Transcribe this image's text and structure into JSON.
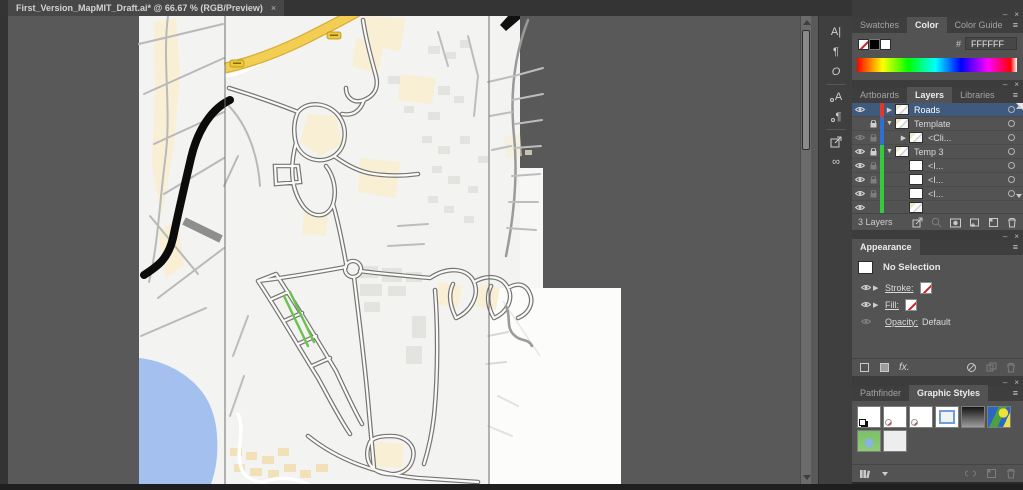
{
  "window": {
    "tab_title": "First_Version_MapMIT_Draft.ai* @ 66.67 % (RGB/Preview)",
    "tab_close_glyph": "×"
  },
  "colors": {
    "pasteboard": "#595959",
    "panel_body": "#535353",
    "panel_tabs_bg": "#3e3e3e",
    "selected_layer_row": "#3f5a7c",
    "layer_color_roads": "#e0392b",
    "layer_color_template": "#2f6fd0",
    "layer_color_temp3": "#35c93f",
    "map_background": "#f3f3f1",
    "map_water": "#a3c0ee",
    "map_major_road_yellow": "#f3ce55",
    "map_heavy_road_black": "#0b0b0b",
    "map_parcel_cream": "#f8efd5",
    "map_green_street": "#69c24a",
    "hex_swatch": "#FFFFFF"
  },
  "dock": {
    "items": [
      {
        "name": "character-panel-icon",
        "glyph": "A|"
      },
      {
        "name": "paragraph-panel-icon",
        "glyph": "¶"
      },
      {
        "name": "opentype-panel-icon",
        "glyph": "O"
      },
      {
        "name": "character-styles-panel-icon",
        "glyph": "A"
      },
      {
        "name": "paragraph-styles-panel-icon",
        "glyph": "¶"
      },
      {
        "name": "export-panel-icon",
        "glyph": ""
      },
      {
        "name": "links-panel-icon",
        "glyph": "∞"
      }
    ]
  },
  "panel_controls": {
    "minimize_glyph": "–",
    "close_glyph": "×",
    "menu_glyph": "≡"
  },
  "panels": {
    "color": {
      "tabs": {
        "swatches": "Swatches",
        "color": "Color",
        "color_guide": "Color Guide"
      },
      "active_tab": "Color",
      "hash_label": "#",
      "hex_value": "FFFFFF"
    },
    "layers": {
      "tabs": {
        "artboards": "Artboards",
        "layers": "Layers",
        "libraries": "Libraries"
      },
      "active_tab": "Layers",
      "rows": [
        {
          "name": "Roads",
          "color": "#e0392b",
          "selected": true,
          "eye": "on",
          "lock": "none",
          "expand": "collapsed",
          "indent": 0
        },
        {
          "name": "Template",
          "color": "#2f6fd0",
          "selected": false,
          "eye": "off",
          "lock": "on",
          "expand": "expanded",
          "indent": 0
        },
        {
          "name": "<Cli...",
          "color": "#2f6fd0",
          "selected": false,
          "eye": "dim",
          "lock": "dim",
          "expand": "collapsed",
          "indent": 1
        },
        {
          "name": "Temp 3",
          "color": "#35c93f",
          "selected": false,
          "eye": "on",
          "lock": "on",
          "expand": "expanded",
          "indent": 0
        },
        {
          "name": "<I...",
          "color": "#35c93f",
          "selected": false,
          "eye": "on",
          "lock": "dim",
          "expand": "none",
          "indent": 1
        },
        {
          "name": "<I...",
          "color": "#35c93f",
          "selected": false,
          "eye": "on",
          "lock": "dim",
          "expand": "none",
          "indent": 1
        },
        {
          "name": "<I...",
          "color": "#35c93f",
          "selected": false,
          "eye": "on",
          "lock": "dim",
          "expand": "none",
          "indent": 1
        },
        {
          "name": "",
          "color": "#35c93f",
          "selected": false,
          "eye": "on",
          "lock": "dim",
          "expand": "none",
          "indent": 1,
          "partial": true
        }
      ],
      "status": "3 Layers"
    },
    "appearance": {
      "tab": "Appearance",
      "no_selection": "No Selection",
      "stroke_label": "Stroke:",
      "fill_label": "Fill:",
      "opacity_label": "Opacity:",
      "opacity_value": "Default",
      "fx_label": "fx."
    },
    "styles": {
      "tabs": {
        "pathfinder": "Pathfinder",
        "graphic_styles": "Graphic Styles"
      },
      "active_tab": "Graphic Styles"
    }
  }
}
